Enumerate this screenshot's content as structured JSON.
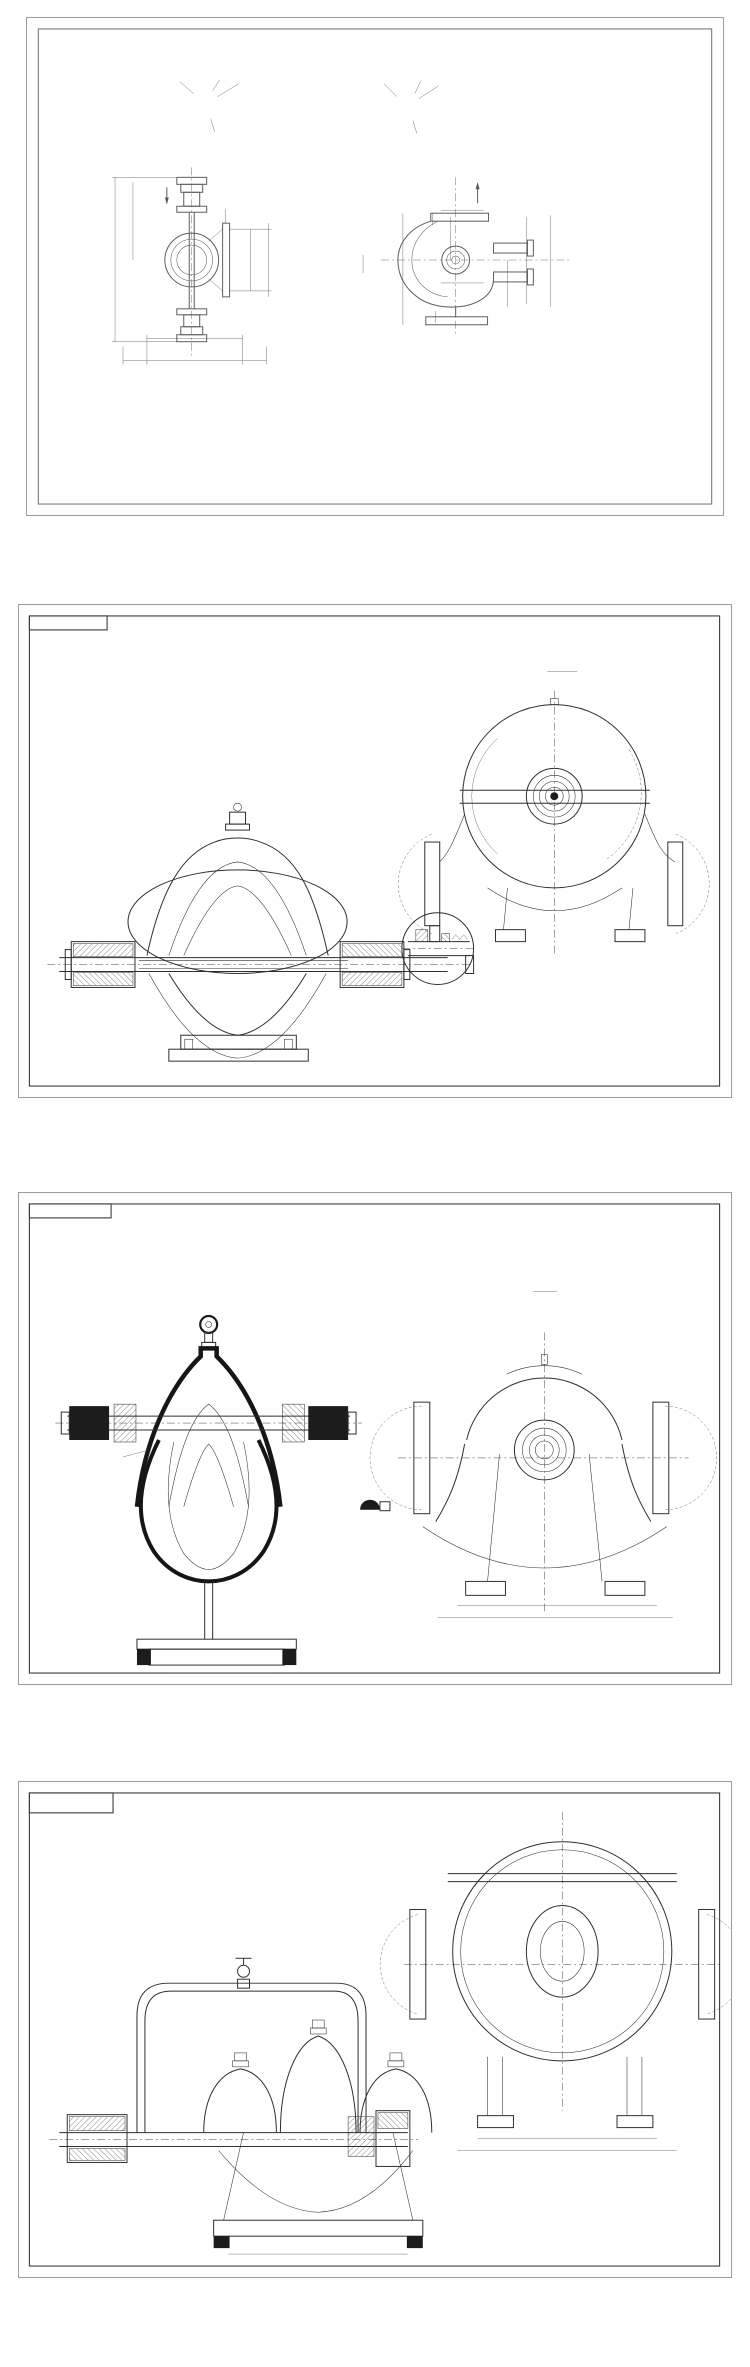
{
  "page": {
    "background": "#ffffff",
    "caption_color": "#49494c",
    "line_color": "#2f2f2f",
    "frame_outer_color": "#9c9ca0",
    "frame_inner_color": "#85858a"
  },
  "panels": [
    {
      "id": "p1",
      "caption": "1200S-85安装尺寸图",
      "model_vertical_label": "1200S-85",
      "inlet_flange": {
        "label": "进口法兰",
        "bolt_spec": "32-Φ48",
        "bolt_circle": "1390",
        "outer_dia": "1485",
        "nominal": "1200"
      },
      "outlet_flange": {
        "label": "出口法兰",
        "bolt_spec": "24-Φ39",
        "bolt_circle": "950",
        "outer_dia": "1025",
        "nominal": "800"
      },
      "front_view": {
        "section_mark": "A",
        "height_total": "3167",
        "height_upper": "1700",
        "anchor_spec": "4-Φ56",
        "width_inner": "1100",
        "width_outer": "1400",
        "base_width": "1400",
        "base_width_outer": "2400"
      },
      "plan_view": {
        "section_mark": "A",
        "d1": "58",
        "d2": "700",
        "d3": "2800",
        "d4": "1400",
        "d5": "60",
        "d6": "650",
        "d7": "650",
        "d8": "1700",
        "d9": "700",
        "d10": "400",
        "d11": "60"
      }
    },
    {
      "id": "p2",
      "caption": "KQSN450-M6安装尺寸图",
      "sheet_code": "KQSN450-M6/W-000ZB",
      "section_label": "A - A",
      "section_scale": "1:7",
      "detail_label": "涨圈密封",
      "callouts_left": [
        "1",
        "2",
        "3",
        "4",
        "5",
        "6",
        "7",
        "8",
        "9",
        "27",
        "10",
        "11",
        "12",
        "13",
        "14"
      ],
      "callouts_right": [
        "15",
        "16",
        "17",
        "18",
        "19",
        "20",
        "21",
        "22",
        "23",
        "24",
        "25",
        "26",
        "22"
      ],
      "callouts_detail": [
        "28",
        "29",
        "30",
        "31",
        "32",
        "33",
        "34",
        "35"
      ],
      "tech_req": {
        "title": "技 术 要 求",
        "lines": [
          "1 因火管等管螺纹联接处必须缠上四氟密封带处理, 拧紧后不得有渗漏现象。",
          "2 当进口压力 ≥0.10MPa时, 取消因火管联接, 需将图示补代第一个堵死。",
          "3 泵装配完毕后, 盘动联轴器, 转子转动应灵活均匀, 无卡滞现象。",
          "4 盘根轴封泄漏量, 需为密封腔内压力所控制, 轴向窜动量应在上限值,",
          "   与泵外形间隙相匹配。"
        ]
      },
      "title_block": {
        "product": "中开式双吸离心泵装配图",
        "drawing_no": "KQSN450-M6/W-000"
      }
    },
    {
      "id": "p3",
      "caption": "OS800-970安装尺寸图",
      "sheet_code": "OS-(X)00-000ZS",
      "scale_label": "1:12",
      "detail_label": "P-P",
      "tap_label": "2-Rp1/2",
      "view_model_label": "OS800-970",
      "callouts_section": [
        "1",
        "2",
        "3",
        "4",
        "5",
        "6",
        "7",
        "8"
      ],
      "callouts_right_a": [
        "9",
        "10",
        "11",
        "12",
        "13",
        "14"
      ],
      "callouts_right_b": [
        "15",
        "16",
        "17"
      ],
      "tech_req": {
        "title": "技术要求",
        "lines": [
          "1、装配前对所有零部件进行清洗并保持清洁。",
          "2、整机装配后, 盘车应灵活, 不得有卡滞、碰擦等现象。",
          "3、试运转正常, 经检验合格为最终交付之合格依据 。"
        ]
      },
      "title_block": {
        "product": "OS800-970型双吸离心泵",
        "drawing_name": "装配图"
      }
    },
    {
      "id": "p4",
      "caption": "SLOW800-980安装尺寸图",
      "sheet_code_line1": "SB-(X)00-000W'Z",
      "sheet_code_line2": "00-00-000'Z",
      "tech_req": {
        "title": "技 术 要 求",
        "lines": [
          "1、装配前, 所有的零件必须清洗干净并检验合格, 清理干净, 并作防锈处理。",
          "2、装配后, 转动转子应平稳灵活均匀, 不得有卡滞、碰擦等现象。",
          "3、装配完毕, 作静压试验, 不得有渗、冒、滴等现象。",
          "4、密封分为机械密封和填料密封, 可按用户的要求使用其技术选用。",
          "5、本泵配置同于性轴承结构"
        ]
      },
      "title_block": {
        "drawing_name": "装配图",
        "sub_label": "(外形安装)",
        "drawing_no": "SLOW800-980(Ⅰ)-00"
      }
    }
  ]
}
